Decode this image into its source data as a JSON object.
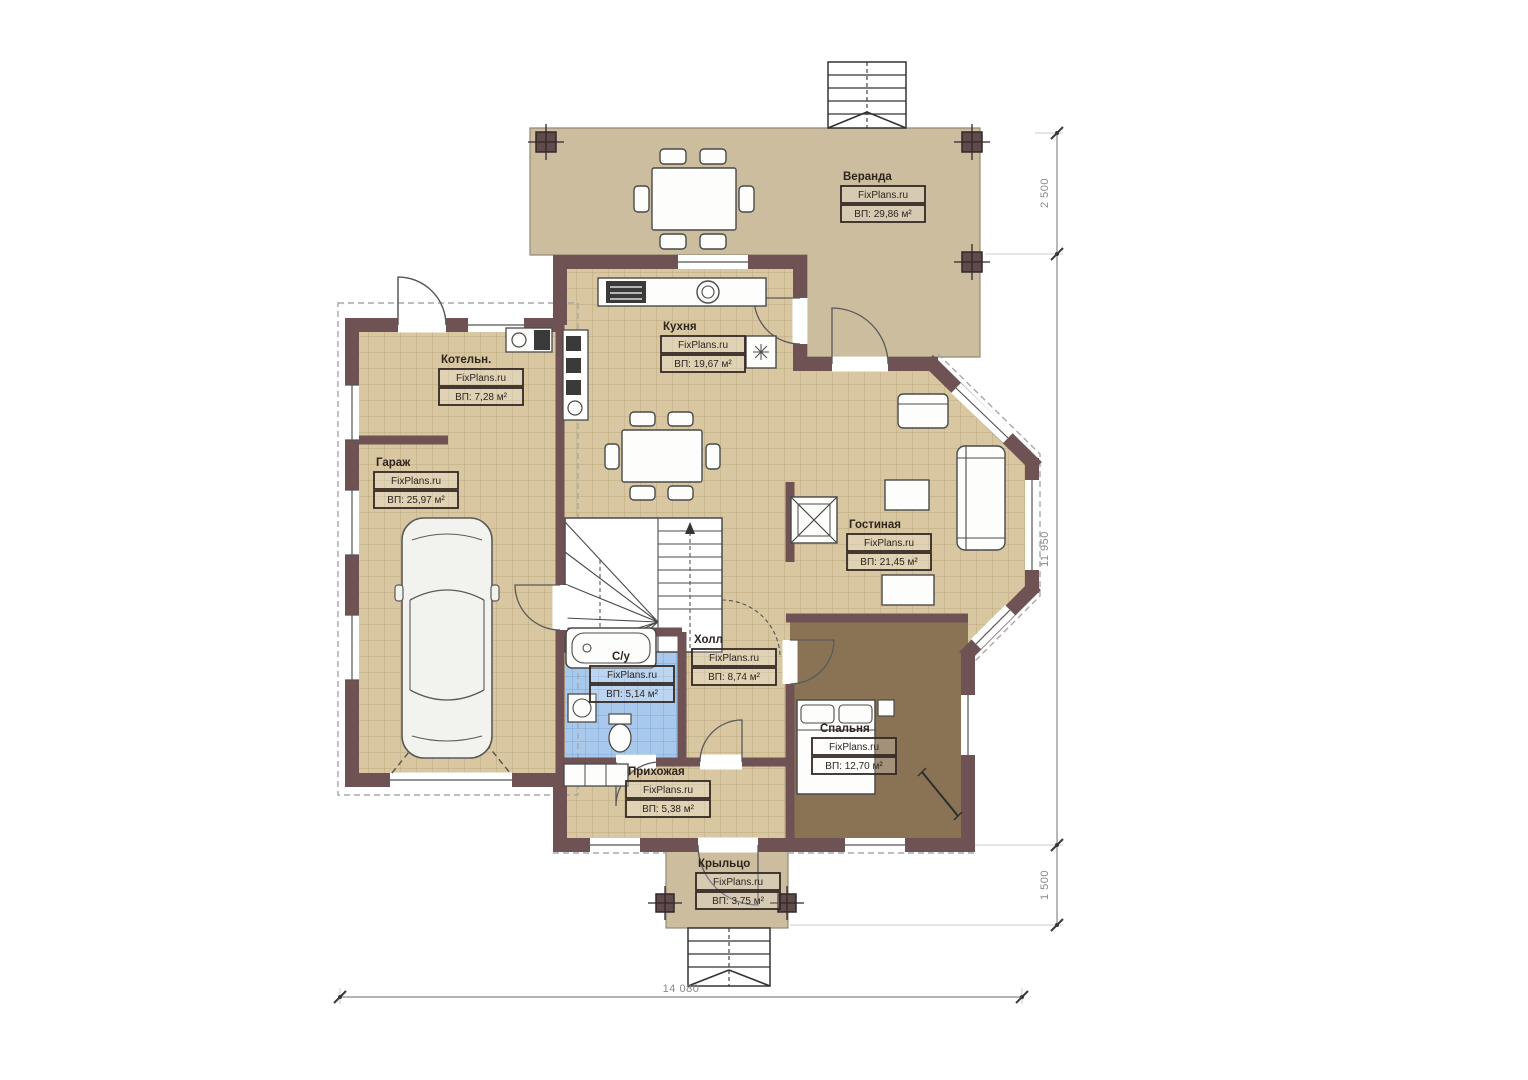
{
  "title": "House first floor plan",
  "watermark": "FixPlans.ru",
  "rooms": [
    {
      "name": "Веранда",
      "area": "ВП: 29,86 м²"
    },
    {
      "name": "Кухня",
      "area": "ВП: 19,67 м²"
    },
    {
      "name": "Котельн.",
      "area": "ВП: 7,28 м²"
    },
    {
      "name": "Гараж",
      "area": "ВП: 25,97 м²"
    },
    {
      "name": "Гостиная",
      "area": "ВП: 21,45 м²"
    },
    {
      "name": "Холл",
      "area": "ВП: 8,74 м²"
    },
    {
      "name": "С/у",
      "area": "ВП: 5,14 м²"
    },
    {
      "name": "Спальня",
      "area": "ВП: 12,70 м²"
    },
    {
      "name": "Прихожая",
      "area": "ВП: 5,38 м²"
    },
    {
      "name": "Крыльцо",
      "area": "ВП: 3,75 м²"
    }
  ],
  "dimensions": {
    "veranda_depth": "2 500",
    "house_depth": "11 950",
    "porch_depth": "1 500",
    "house_width": "14 080"
  },
  "colors": {
    "wall": "#6e5254",
    "floor_tile": "#d8c7a0",
    "veranda_floor": "#cbbd9d",
    "bedroom_floor": "#8a7354",
    "bathroom_floor": "#a9c9ec",
    "label_border": "#342823",
    "dimension_line": "#9a9a9a"
  }
}
